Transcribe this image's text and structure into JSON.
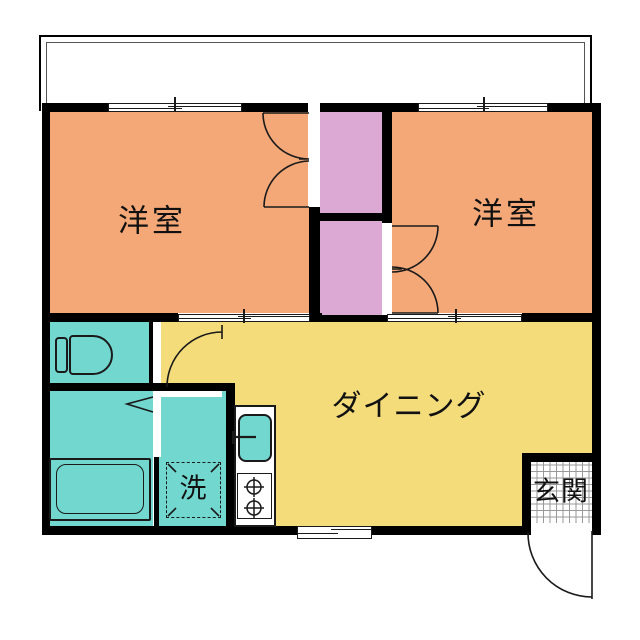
{
  "floorplan": {
    "rooms": {
      "bedroom_left": {
        "label": "洋室"
      },
      "bedroom_right": {
        "label": "洋室"
      },
      "dining": {
        "label": "ダイニング"
      },
      "laundry": {
        "label": "洗"
      },
      "entrance": {
        "label": "玄関"
      }
    },
    "icons": {
      "toilet": "toilet-icon",
      "bathtub": "bathtub-icon",
      "washer_space": "washing-machine-space",
      "sink": "kitchen-sink-icon",
      "stove": "stove-burners-icon",
      "entrance_tile": "entrance-tile-grid",
      "door_arcs": "door-swing-arc"
    },
    "colors": {
      "bedroom": "#F4A878",
      "closet": "#DCA8D4",
      "wet": "#72D8CF",
      "dining": "#F5DC7B",
      "wall": "#000000",
      "line": "#1A1A1A",
      "grid_line": "#999999"
    }
  }
}
